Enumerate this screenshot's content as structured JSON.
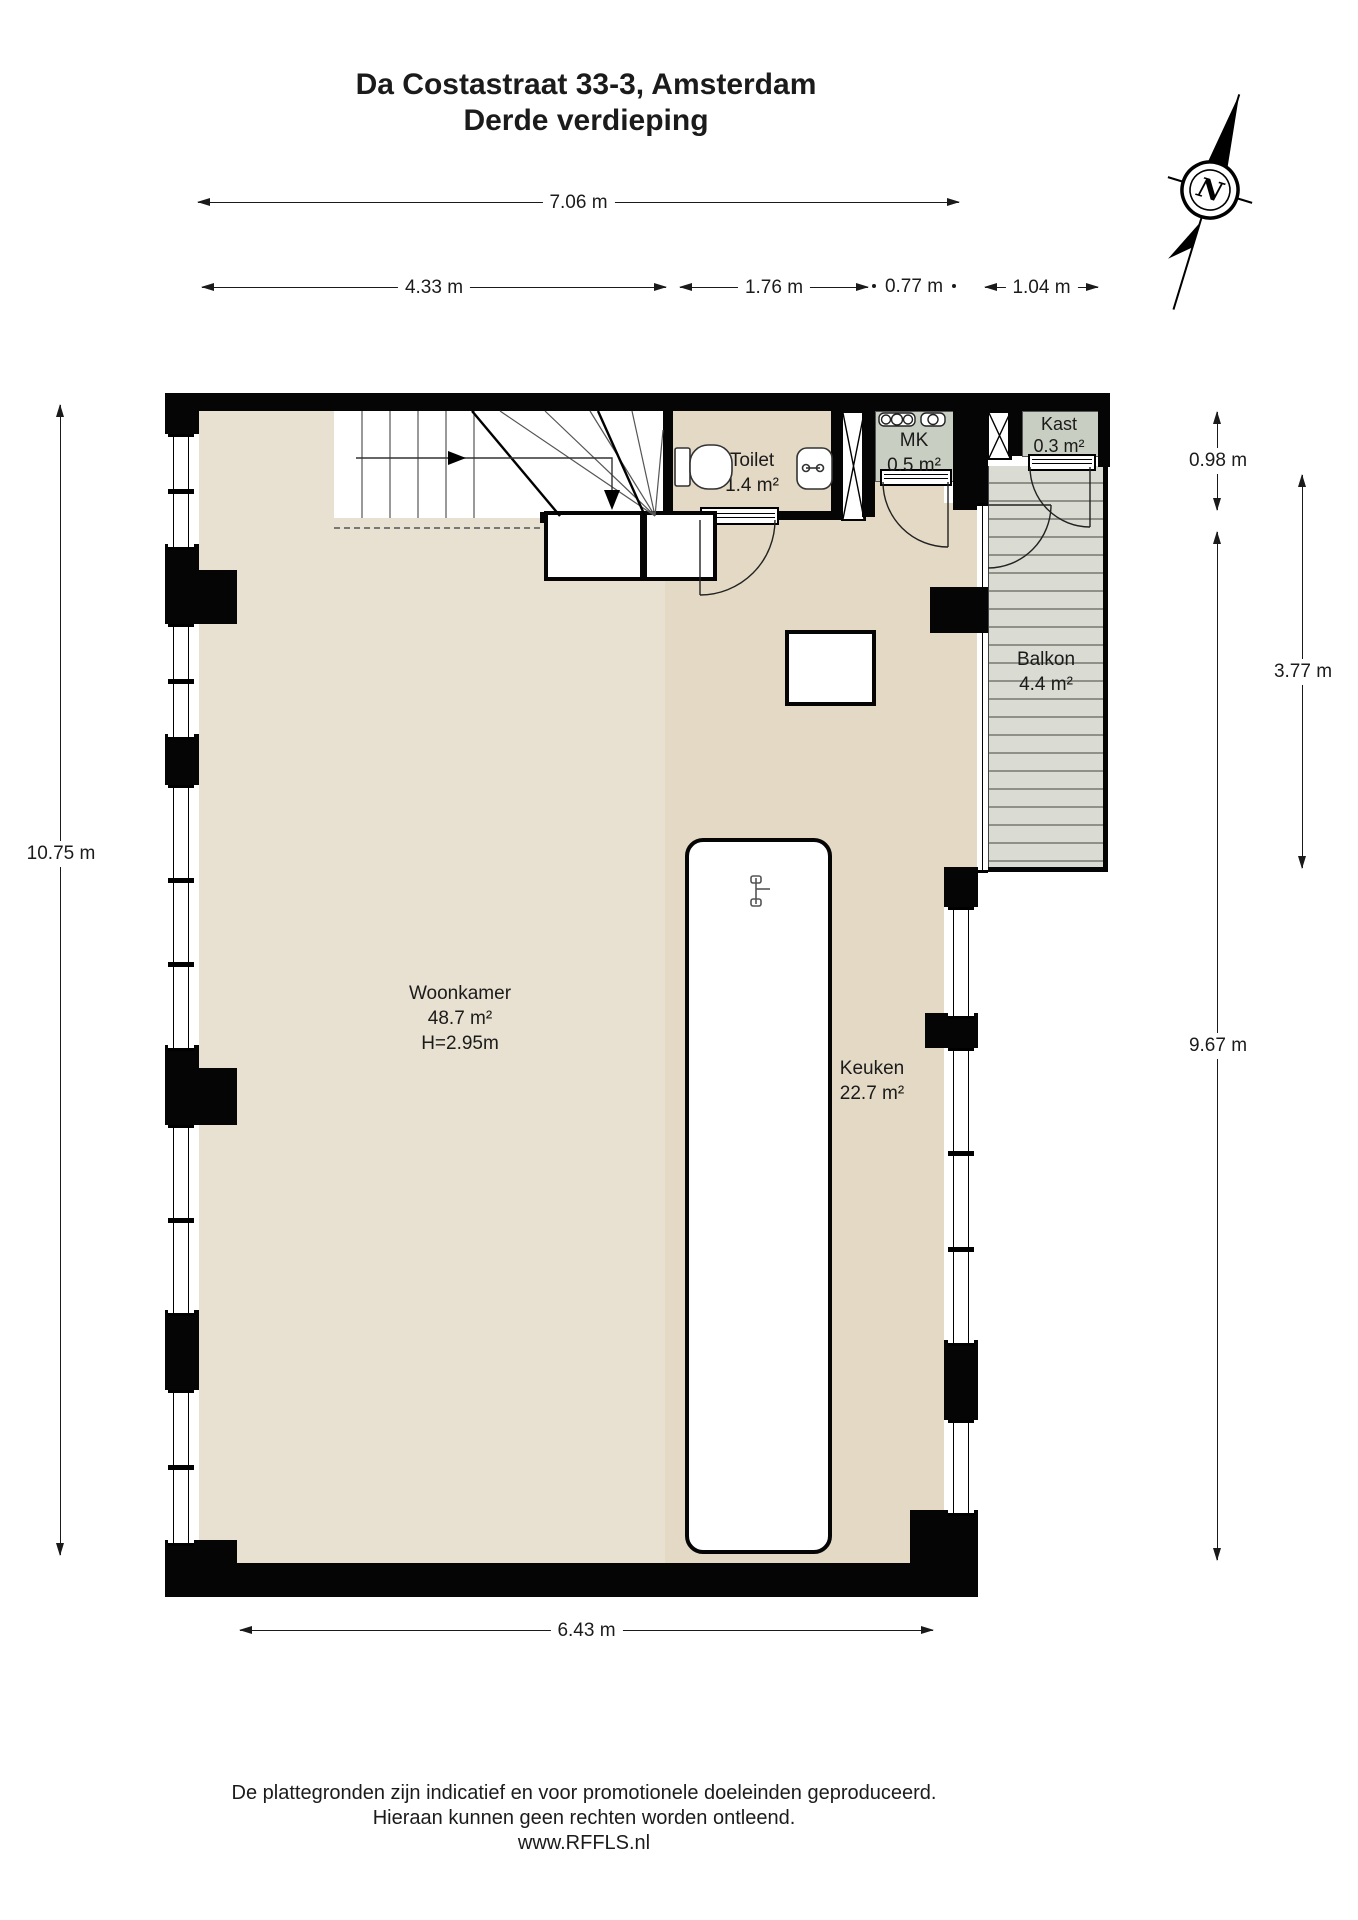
{
  "title": {
    "line1": "Da Costastraat 33-3, Amsterdam",
    "line2": "Derde verdieping"
  },
  "dimensions": {
    "top_total": "7.06 m",
    "top_a": "4.33 m",
    "top_b": "1.76 m",
    "top_c": "0.77 m",
    "top_d": "1.04 m",
    "left_total": "10.75 m",
    "right_top": "0.98 m",
    "right_balcony": "3.77 m",
    "right_main": "9.67 m",
    "bottom": "6.43 m"
  },
  "rooms": {
    "woonkamer": {
      "name": "Woonkamer",
      "area": "48.7 m²",
      "ceiling_height": "H=2.95m"
    },
    "keuken": {
      "name": "Keuken",
      "area": "22.7 m²"
    },
    "toilet": {
      "name": "Toilet",
      "area": "1.4 m²"
    },
    "mk": {
      "name": "MK",
      "area": "0.5 m²"
    },
    "kast": {
      "name": "Kast",
      "area": "0.3 m²"
    },
    "balkon": {
      "name": "Balkon",
      "area": "4.4 m²"
    }
  },
  "compass": {
    "label": "N"
  },
  "footer": {
    "line1": "De plattegronden zijn indicatief en voor promotionele doeleinden geproduceerd.",
    "line2": "Hieraan kunnen geen rechten worden ontleend.",
    "line3": "www.RFFLS.nl"
  },
  "colors": {
    "wall": "#050505",
    "floor_livingroom": "#e8e0d0",
    "floor_kitchen": "#e3d9c5",
    "closet_gray": "#c9cec2",
    "balcony_deck": "#dadbd2",
    "balcony_stripe": "#8f9087",
    "dimension_ink": "#1a1a1a"
  }
}
